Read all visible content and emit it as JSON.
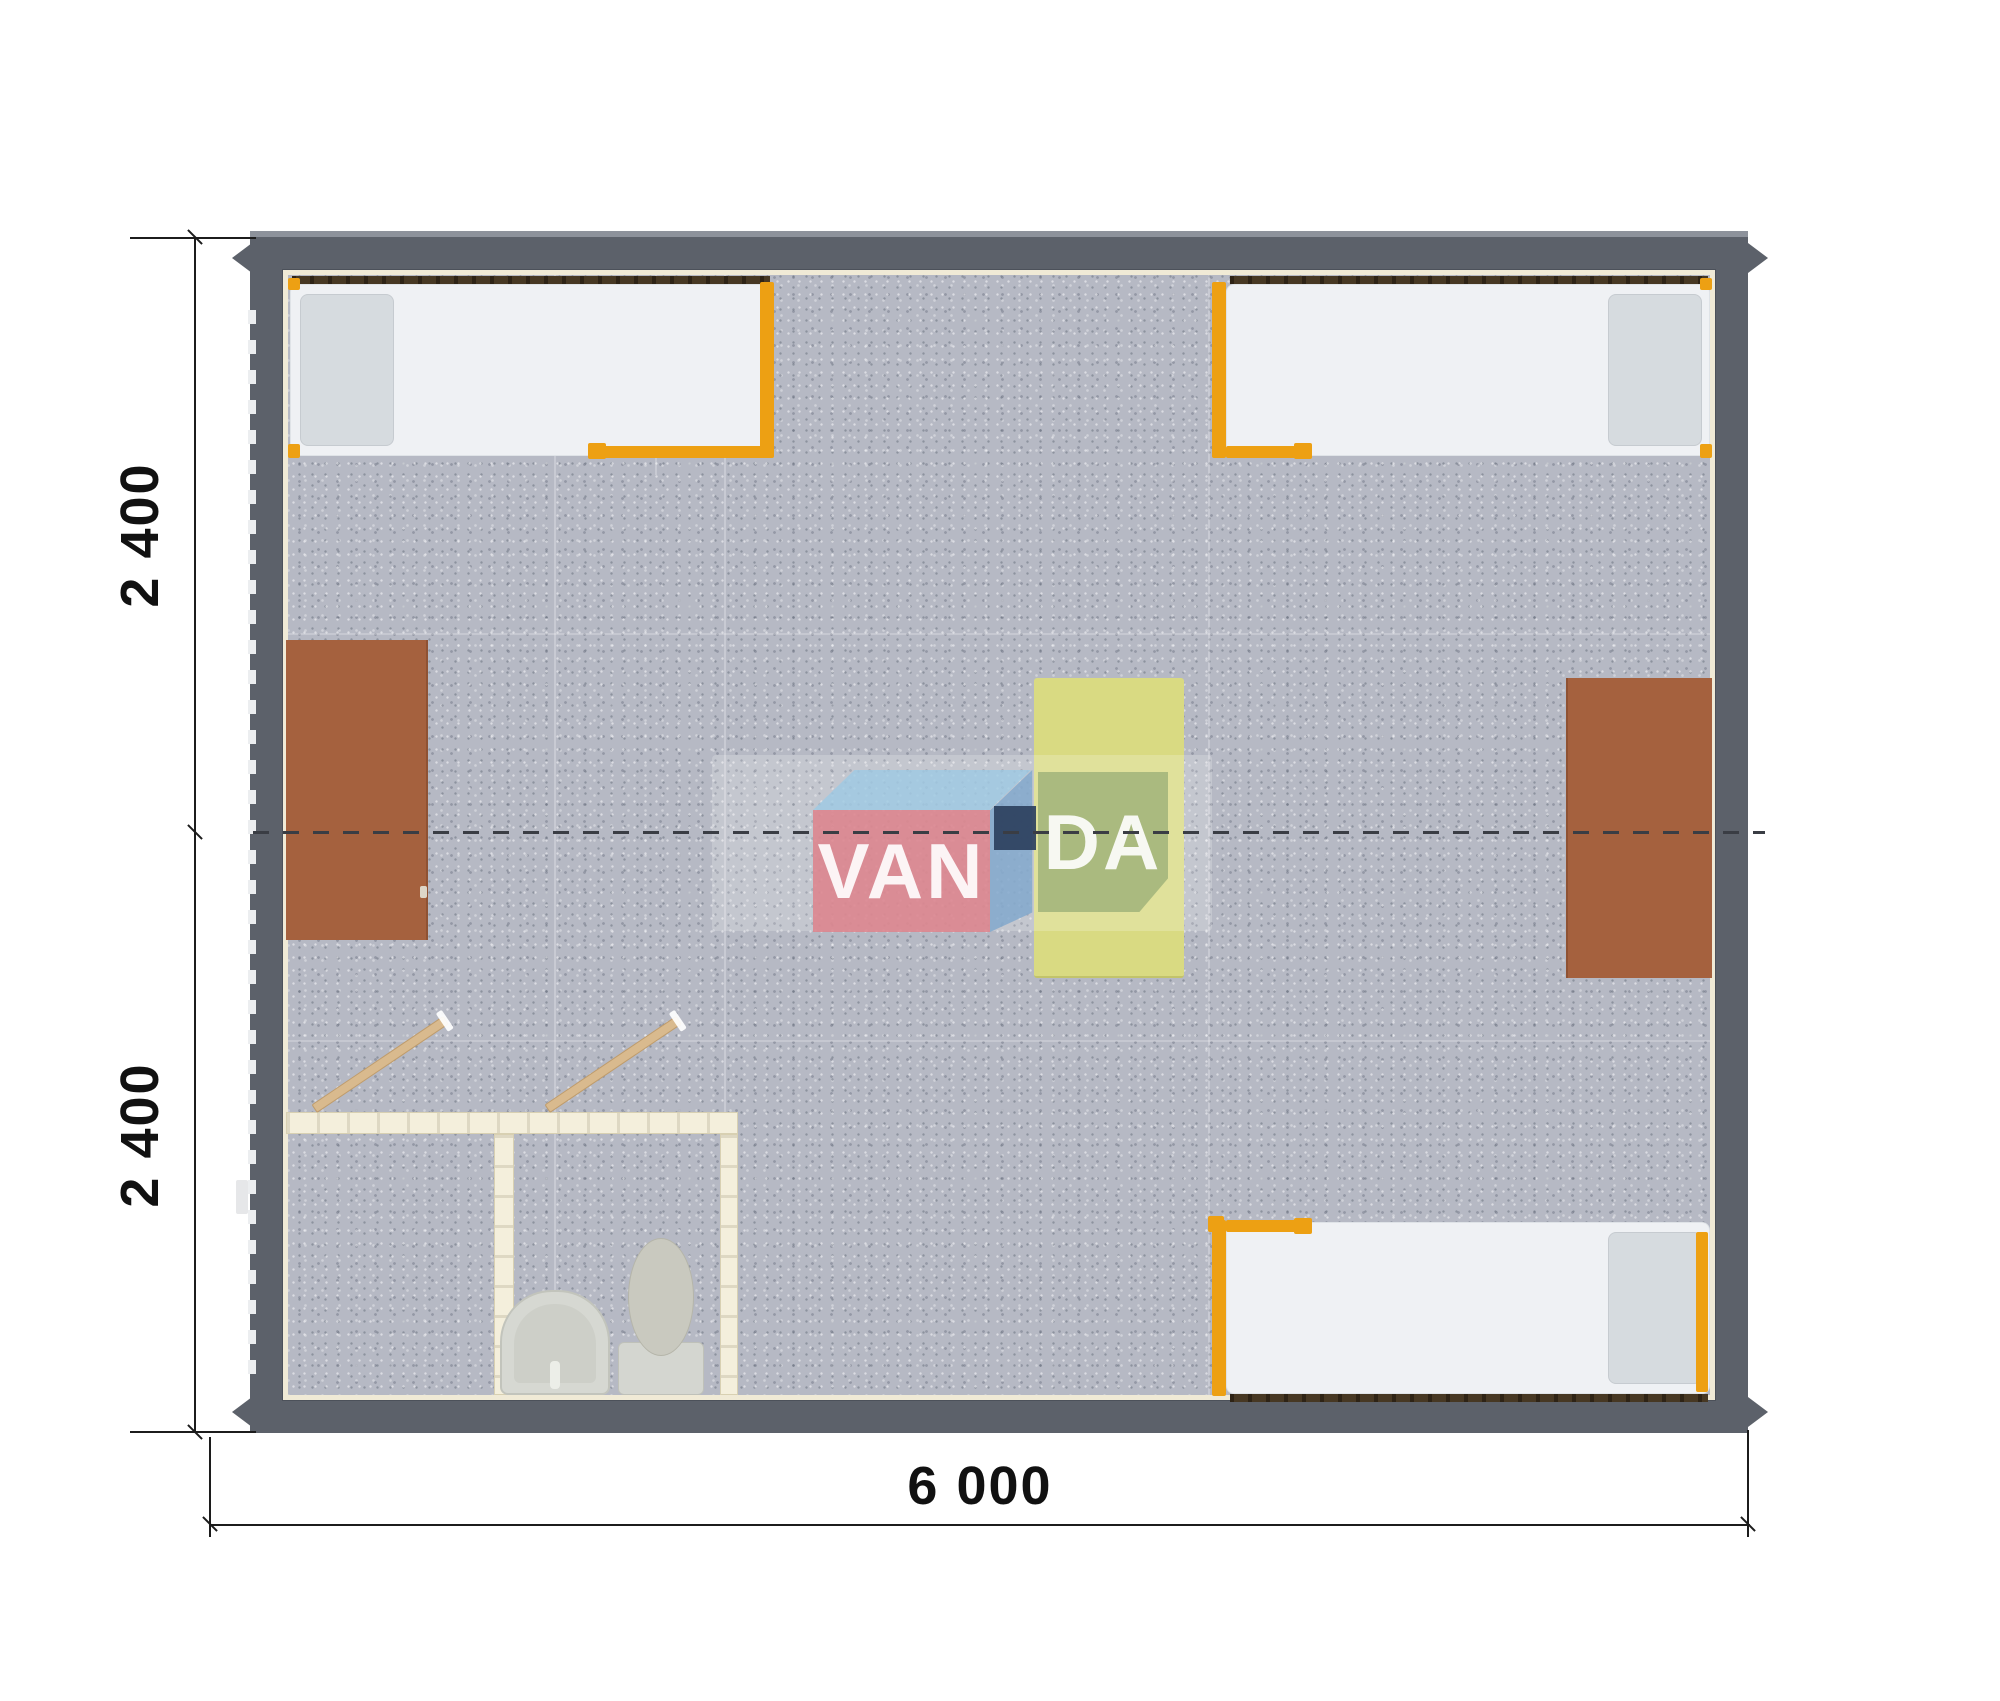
{
  "watermark": {
    "brand_full": "VANDA",
    "brand_part1": "VAN",
    "brand_part2": "DA"
  },
  "dimensions": {
    "bottom_width": "6 000",
    "left_height_top": "2 400",
    "left_height_bottom": "2 400"
  },
  "colors": {
    "wall_gray": "#5c616a",
    "floor_gray": "#b6b9c4",
    "liner_cream": "#f0ead6",
    "accent_orange": "#eda013",
    "desk_brown": "#a5613e",
    "table_yellow": "#d9da82",
    "bathroom_wall_cream": "#f4efdc",
    "door_wood": "#d9ba8e",
    "fixture_gray": "#d6d8d2",
    "logo_pink": "#dd848d",
    "logo_blue_top": "#9ec9e4",
    "logo_blue_side": "#82a8cc",
    "logo_navy": "#2d405e",
    "logo_green": "#86a06c",
    "dimension_ink": "#1c1c1c"
  }
}
